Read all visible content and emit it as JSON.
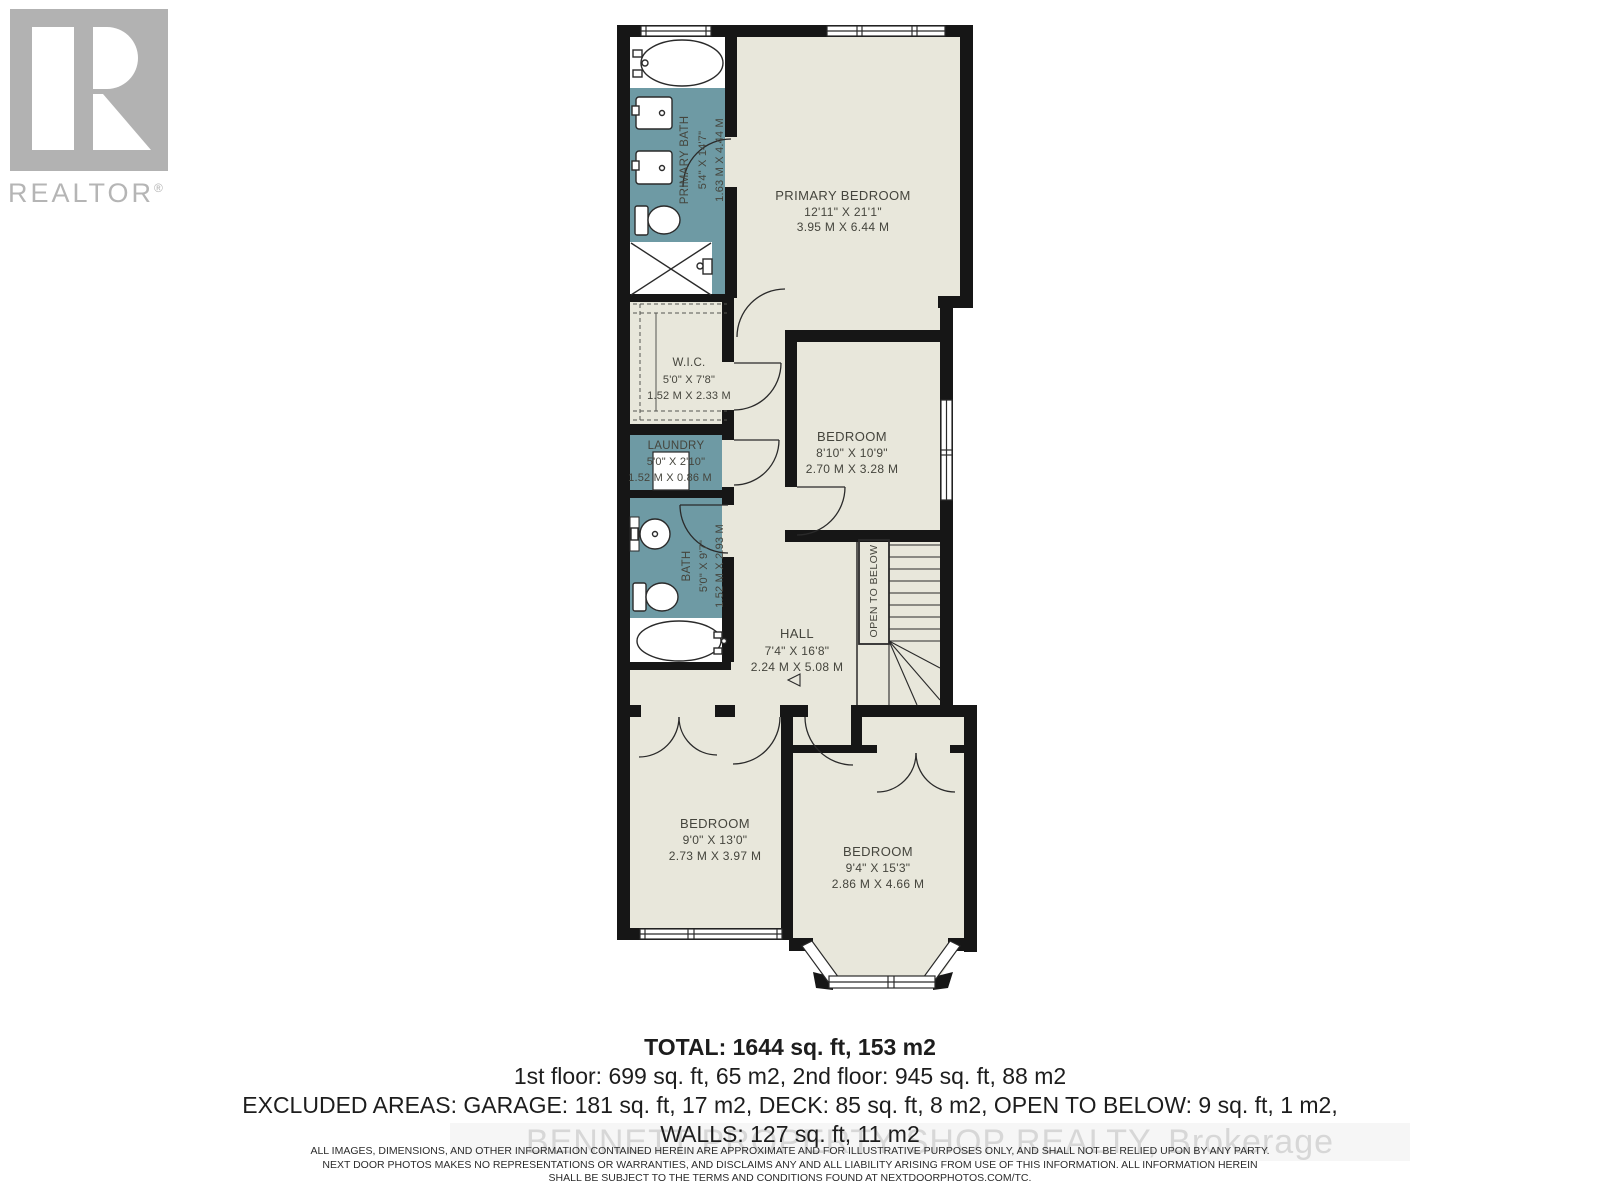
{
  "branding": {
    "realtor_logo_text": "REALTOR",
    "registered_mark": "®"
  },
  "rooms": {
    "primary_bath": {
      "name": "PRIMARY BATH",
      "imperial": "5'4\" X 14'7\"",
      "metric": "1.63 M X 4.44 M"
    },
    "primary_bedroom": {
      "name": "PRIMARY BEDROOM",
      "imperial": "12'11\" X 21'1\"",
      "metric": "3.95 M X 6.44 M"
    },
    "wic": {
      "name": "W.I.C.",
      "imperial": "5'0\" X 7'8\"",
      "metric": "1.52 M X 2.33 M"
    },
    "laundry": {
      "name": "LAUNDRY",
      "imperial": "5'0\" X 2'10\"",
      "metric": "1.52 M X 0.86 M"
    },
    "bath": {
      "name": "BATH",
      "imperial": "5'0\" X 9'7\"",
      "metric": "1.52 M X 2.93 M"
    },
    "bedroom_mid": {
      "name": "BEDROOM",
      "imperial": "8'10\" X 10'9\"",
      "metric": "2.70 M X 3.28 M"
    },
    "hall": {
      "name": "HALL",
      "imperial": "7'4\" X 16'8\"",
      "metric": "2.24 M X 5.08 M"
    },
    "bedroom_left": {
      "name": "BEDROOM",
      "imperial": "9'0\" X 13'0\"",
      "metric": "2.73 M X 3.97 M"
    },
    "bedroom_right": {
      "name": "BEDROOM",
      "imperial": "9'4\" X 15'3\"",
      "metric": "2.86 M X 4.66 M"
    }
  },
  "annotations": {
    "open_to_below": "OPEN TO BELOW"
  },
  "summary": {
    "total": "TOTAL: 1644 sq. ft, 153 m2",
    "floors": "1st floor: 699 sq. ft, 65 m2, 2nd floor: 945 sq. ft, 88 m2",
    "excluded": "EXCLUDED AREAS: GARAGE: 181 sq. ft, 17 m2, DECK: 85 sq. ft, 8 m2, OPEN TO BELOW: 9 sq. ft, 1 m2,",
    "walls": "WALLS: 127 sq. ft, 11 m2"
  },
  "watermark": "BENNETT PROPERTY SHOP REALTY, Brokerage",
  "disclaimer": {
    "line1": "ALL IMAGES, DIMENSIONS, AND OTHER INFORMATION CONTAINED HEREIN ARE APPROXIMATE AND FOR ILLUSTRATIVE PURPOSES ONLY, AND SHALL NOT BE RELIED UPON BY ANY PARTY.",
    "line2": "NEXT DOOR PHOTOS MAKES NO REPRESENTATIONS OR WARRANTIES, AND DISCLAIMS ANY AND ALL LIABILITY ARISING FROM USE OF THIS INFORMATION. ALL INFORMATION HEREIN",
    "line3": "SHALL BE SUBJECT TO THE TERMS AND CONDITIONS FOUND AT NEXTDOORPHOTOS.COM/TC."
  },
  "colors": {
    "wall": "#161616",
    "floor": "#e8e7db",
    "wet_room": "#6e9aa4",
    "logo_gray": "#b2b2b2",
    "label": "#45453d"
  }
}
